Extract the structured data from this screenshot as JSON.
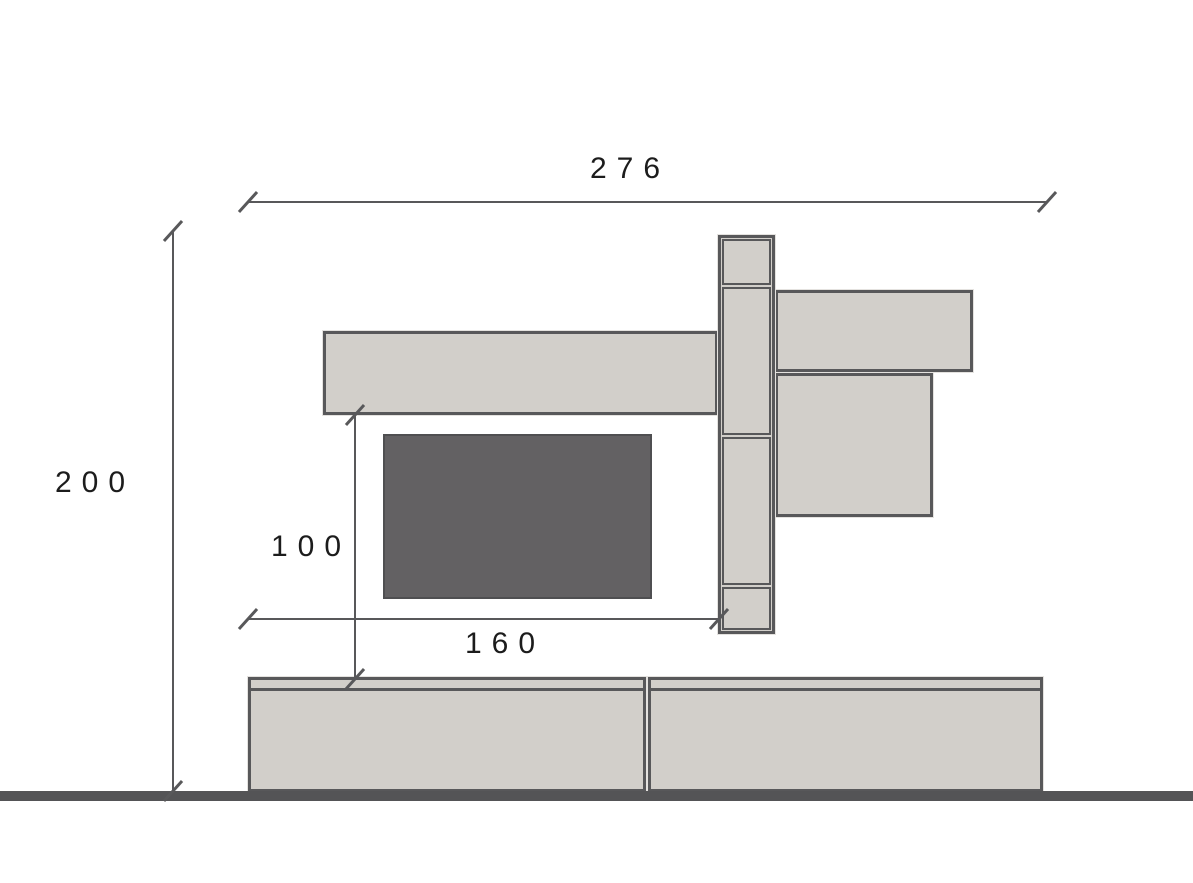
{
  "drawing": {
    "title": "wall-unit-elevation",
    "dimensions": {
      "total_width": {
        "value": "276",
        "orientation": "horizontal"
      },
      "total_height": {
        "value": "200",
        "orientation": "vertical"
      },
      "tv_area_height": {
        "value": "100",
        "orientation": "vertical"
      },
      "tv_area_width": {
        "value": "160",
        "orientation": "horizontal"
      }
    },
    "colors": {
      "panel_fill": "#d2cfca",
      "panel_border": "#58585a",
      "tv_fill": "#636163",
      "tv_border": "#4f4f51",
      "line": "#58585a",
      "floor": "#545456",
      "bg": "#ffffff",
      "text": "#1c1c1c"
    },
    "components": [
      "top-shelf",
      "tall-cabinet-column",
      "right-shelf",
      "right-wall-panel",
      "tv-screen",
      "base-cabinet-left",
      "base-cabinet-right",
      "floor-line"
    ]
  }
}
